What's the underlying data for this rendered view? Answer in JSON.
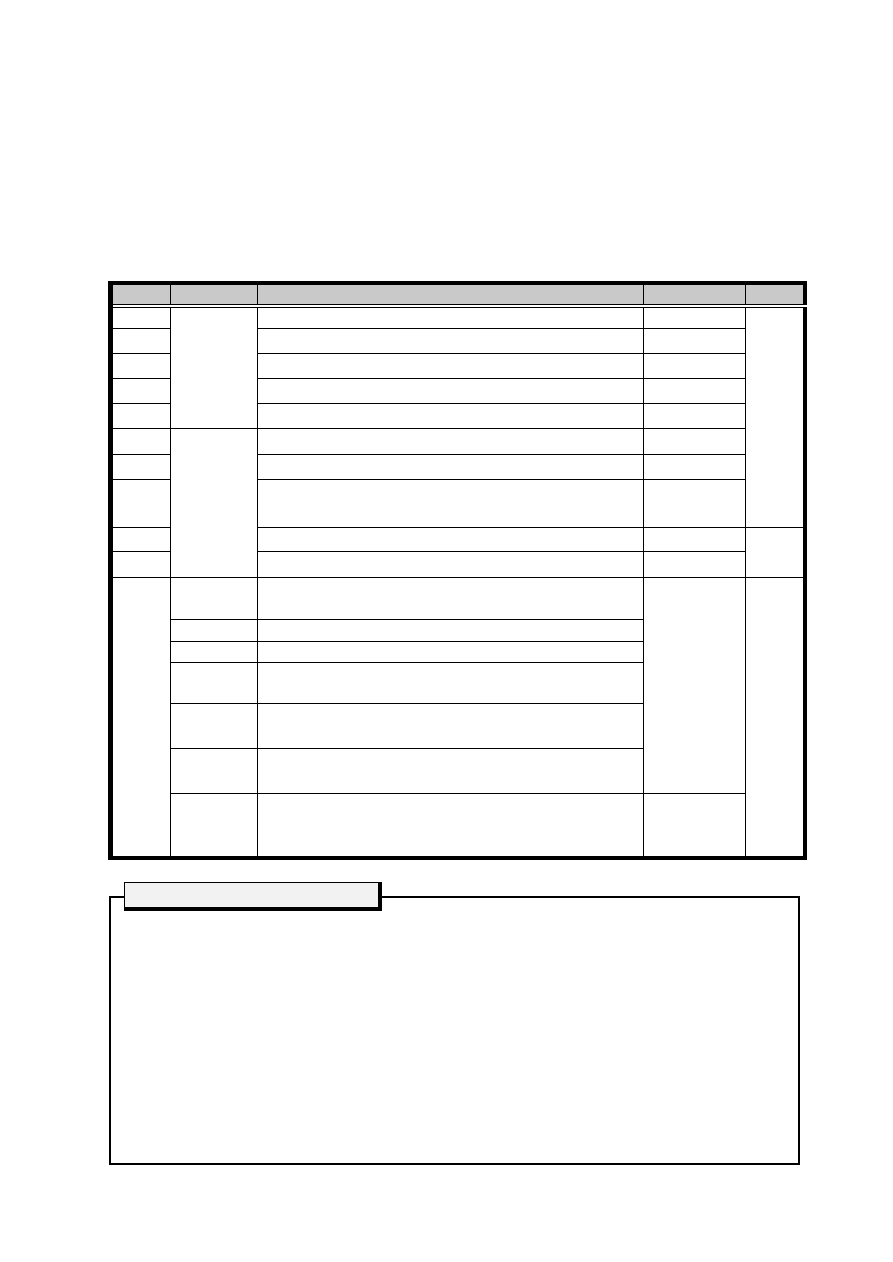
{
  "page": {
    "background": "#ffffff"
  },
  "colors": {
    "line": "#000000",
    "table_header_fill": "#c9c9c9",
    "note_tab_fill": "#f2f2f2",
    "page_background": "#ffffff"
  },
  "table": {
    "column_count": 5,
    "body_row_count": 17,
    "all_cells_empty": true,
    "header_labels": [
      "",
      "",
      "",
      "",
      ""
    ]
  },
  "note_box": {
    "tab_label": "",
    "body_text": ""
  }
}
